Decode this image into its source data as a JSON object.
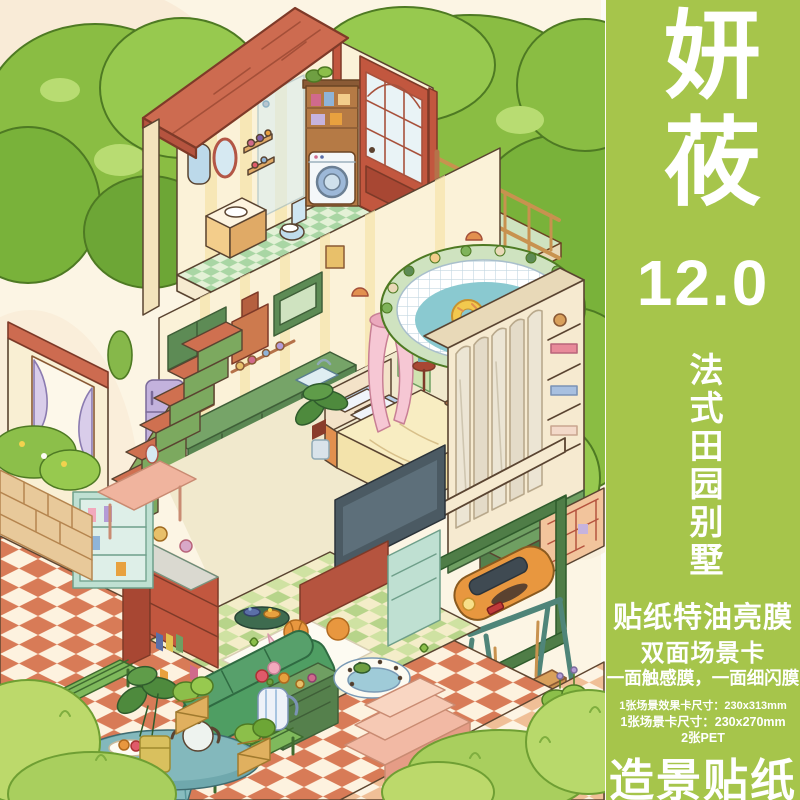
{
  "banner": {
    "brand": "妍莜",
    "version": "12.0",
    "series_vertical": "法式田园别墅",
    "feature_title": "贴纸特油亮膜",
    "feature_line2": "双面场景卡",
    "feature_line3": "一面触感膜，一面细闪膜",
    "specs": [
      "1张场景效果卡尺寸：230x313mm",
      "1张场景卡尺寸：230x270mm",
      "2张PET"
    ],
    "footer": "造景贴纸"
  },
  "colors": {
    "banner_green": "#a6c54b",
    "bg_cream": "#fcf5e4",
    "text_white": "#ffffff",
    "roof_terracotta": "#cd6b50",
    "tree_green": "#8cbf4a",
    "pool_teal": "#8ac9d0",
    "patio_terracotta": "#d87b57",
    "sofa_green": "#57a06b",
    "wood_tan": "#b57a45"
  },
  "illustration": {
    "alt": "Isometric cutaway French countryside villa: attic bathroom with tub, washer and red french door with balcony; middle floor bedroom with canopy bed, wardrobe, kitchen and staircase; outdoor oval pool with donut float; ground floor living room with green sofa, TV and bookshelf; garden patio with checkered tiles, teal table, plants, swing and orange car; large green trees around."
  }
}
